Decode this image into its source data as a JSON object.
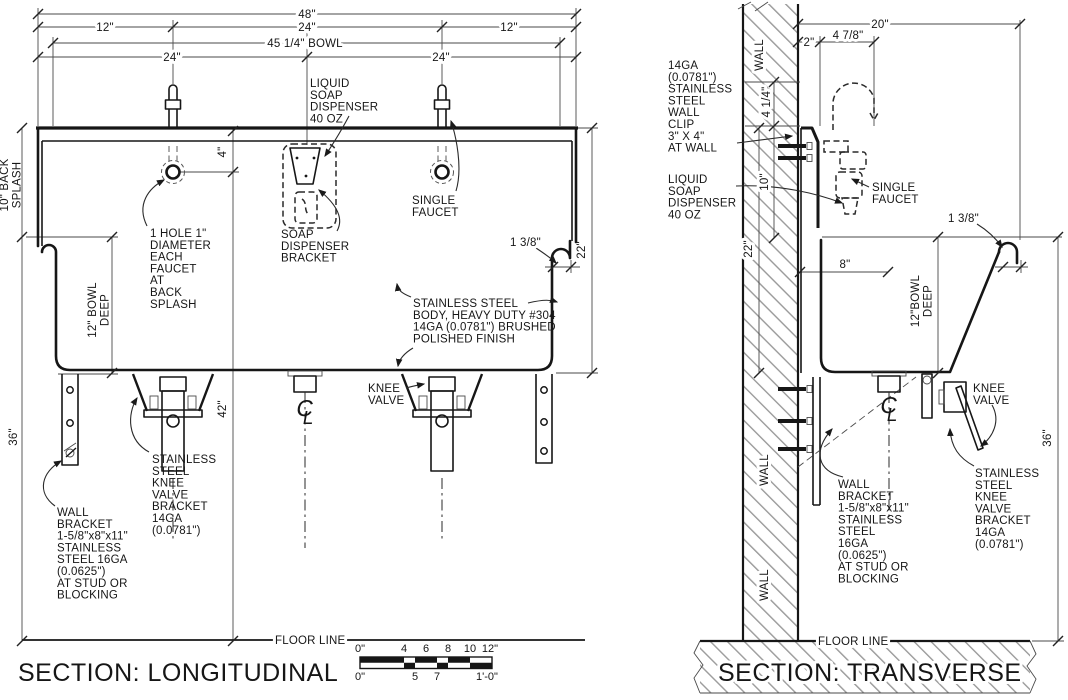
{
  "longitudinal": {
    "title": "SECTION: LONGITUDINAL",
    "floor_label": "FLOOR LINE",
    "dims": {
      "overall": "48\"",
      "seg_left": "12\"",
      "seg_mid": "24\"",
      "seg_right": "12\"",
      "bowl_width": "45 1/4\" BOWL",
      "faucet_left": "24\"",
      "faucet_right": "24\"",
      "backsplash_l1": "10\" BACK",
      "backsplash_l2": "SPLASH",
      "bowl_deep_l1": "12\" BOWL",
      "bowl_deep_l2": "DEEP",
      "floor_to_rim": "36\"",
      "faucet_drop": "4\"",
      "valve_height": "42\"",
      "overall_depth": "22\"",
      "rim_roll": "1 3/8\""
    },
    "notes": {
      "liquid_soap": [
        "LIQUID",
        "SOAP",
        "DISPENSER",
        "40 OZ"
      ],
      "soap_bracket": [
        "SOAP",
        "DISPENSER",
        "BRACKET"
      ],
      "single_faucet": [
        "SINGLE",
        "FAUCET"
      ],
      "faucet_hole": [
        "1 HOLE 1\"",
        "DIAMETER",
        "EACH",
        "FAUCET",
        "AT",
        "BACK",
        "SPLASH"
      ],
      "body": [
        "STAINLESS STEEL",
        "BODY, HEAVY DUTY #304",
        "14GA (0.0781\") BRUSHED",
        "POLISHED FINISH"
      ],
      "knee_valve": [
        "KNEE",
        "VALVE"
      ],
      "knee_bracket": [
        "STAINLESS",
        "STEEL",
        "KNEE",
        "VALVE",
        "BRACKET",
        "14GA",
        "(0.0781\")"
      ],
      "wall_bracket": [
        "WALL",
        "BRACKET",
        "1-5/8\"x8\"x11\"",
        "STAINLESS",
        "STEEL 16GA",
        "(0.0625\")",
        "AT STUD OR",
        "BLOCKING"
      ]
    }
  },
  "transverse": {
    "title": "SECTION: TRANSVERSE",
    "floor_label": "FLOOR LINE",
    "wall_label": "WALL",
    "dims": {
      "counter_depth": "20\"",
      "backsplash_thk": "2\"",
      "faucet_reach": "4 7/8\"",
      "spout_height": "4 1/4\"",
      "splash_height": "10\"",
      "overall_depth": "22\"",
      "drain_offset": "8\"",
      "bowl_deep_l1": "12\"BOWL",
      "bowl_deep_l2": "DEEP",
      "rim_roll": "1 3/8\"",
      "floor_to_rim": "36\""
    },
    "notes": {
      "wall_clip": [
        "14GA",
        "(0.0781\")",
        "STAINLESS",
        "STEEL",
        "WALL",
        "CLIP",
        "3\" X 4\"",
        "AT WALL"
      ],
      "liquid_soap": [
        "LIQUID",
        "SOAP",
        "DISPENSER",
        "40 OZ"
      ],
      "single_faucet": [
        "SINGLE",
        "FAUCET"
      ],
      "knee_valve": [
        "KNEE",
        "VALVE"
      ],
      "knee_bracket": [
        "STAINLESS",
        "STEEL",
        "KNEE",
        "VALVE",
        "BRACKET",
        "14GA",
        "(0.0781\")"
      ],
      "wall_bracket": [
        "WALL",
        "BRACKET",
        "1-5/8\"x8\"x11\"",
        "STAINLESS",
        "STEEL",
        "16GA",
        "(0.0625\")",
        "AT STUD OR",
        "BLOCKING"
      ]
    }
  },
  "scale_bar": {
    "top_labels": [
      "0\"",
      "4",
      "6",
      "8",
      "10",
      "12\""
    ],
    "bottom_labels": [
      "0\"",
      "5",
      "7",
      "1'-0\""
    ]
  },
  "colors": {
    "line": "#161616",
    "dim": "#4a4a4a",
    "hatch": "#8f8f8f",
    "background": "#ffffff"
  }
}
